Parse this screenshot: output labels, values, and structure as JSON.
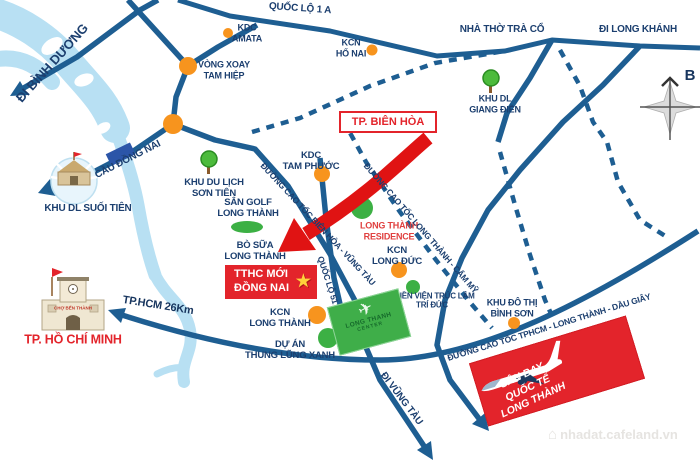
{
  "map": {
    "region_labels": {
      "di_binh_duong": "ĐI BÌNH DƯƠNG",
      "quoc_lo_1a": "QUỐC LỘ 1 A",
      "kdc_amata": "KDC\nAMATA",
      "kcn_ho_nai": "KCN\nHỐ NAI",
      "nha_tho_tra_co": "NHÀ THỜ TRÀ CỔ",
      "di_long_khanh": "ĐI LONG KHÁNH",
      "vong_xoay_tam_hiep": "VÒNG XOAY\nTAM HIỆP",
      "khu_dl_giang_dien": "KHU DL\nGIANG ĐIỀN",
      "cau_dong_nai": "CẦU ĐỒNG NAI",
      "khu_du_lich_son_tien": "KHU DU LỊCH\nSƠN TIÊN",
      "khu_dl_suoi_tien": "KHU DL SUỐI TIÊN",
      "san_golf_long_thanh": "SÂN GOLF\nLONG THÀNH",
      "kdc_tam_phuoc": "KDC\nTAM PHƯỚC",
      "bo_sua_long_thanh": "BÒ SỮA\nLONG THÀNH",
      "kcn_long_duc": "KCN\nLONG ĐỨC",
      "long_thanh_residence": "LONG THÀNH\nRESIDENCE",
      "tphcm_distance": "TP.HCM  26Km",
      "tp_ho_chi_minh": "TP. HỒ CHÍ MINH",
      "kcn_long_thanh": "KCN\nLONG THÀNH",
      "du_an_thung_lung_xanh": "DỰ ÁN\nTHUNG LŨNG XANH",
      "thien_vien_truc_lam": "THIỀN VIỆN TRÚC LÂM\nTRÍ ĐỨC",
      "khu_do_thi_binh_son": "KHU ĐÔ THỊ\nBÌNH SƠN",
      "di_vung_tau": "ĐI VŨNG TÀU"
    },
    "road_labels": {
      "cao_toc_bien_hoa_vung_tau": "ĐƯỜNG CAO TỐC BIÊN HÒA - VŨNG TÀU",
      "quoc_lo_51": "QUỐC LỘ 51",
      "cao_toc_long_thanh_cam_my": "ĐƯỜNG CAO TỐC LONG THÀNH - CẨM MỸ",
      "cao_toc_tphcm_long_thanh_dau_giay": "ĐƯỜNG CAO TỐC TPHCM - LONG THÀNH - DẦU GIÂY"
    },
    "callouts": {
      "tp_bien_hoa": "TP. BIÊN HÒA",
      "tthc": "TTHC MỚI\nĐỒNG NAI",
      "tthc_star": "★",
      "airport": "SÂN BAY\nQUỐC TẾ\nLONG THÀNH",
      "long_thanh_center_line1": "LONG THANH",
      "long_thanh_center_line2": "CENTER",
      "long_thanh_center_plane": "✈",
      "ben_thanh_sign": "CHỢ BẾN THÀNH"
    },
    "compass": {
      "north": "B"
    },
    "watermark": {
      "text": "nhadat.cafeland.vn",
      "house_icon": "⌂"
    },
    "palette": {
      "road_blue": "#1e5e92",
      "label_navy": "#1c3f6f",
      "accent_red": "#e3242b",
      "arrow_red": "#e01313",
      "marker_orange": "#f7941e",
      "marker_green": "#3cb044",
      "river_blue": "#b8e0f3",
      "star_yellow": "#ffd23b"
    }
  }
}
